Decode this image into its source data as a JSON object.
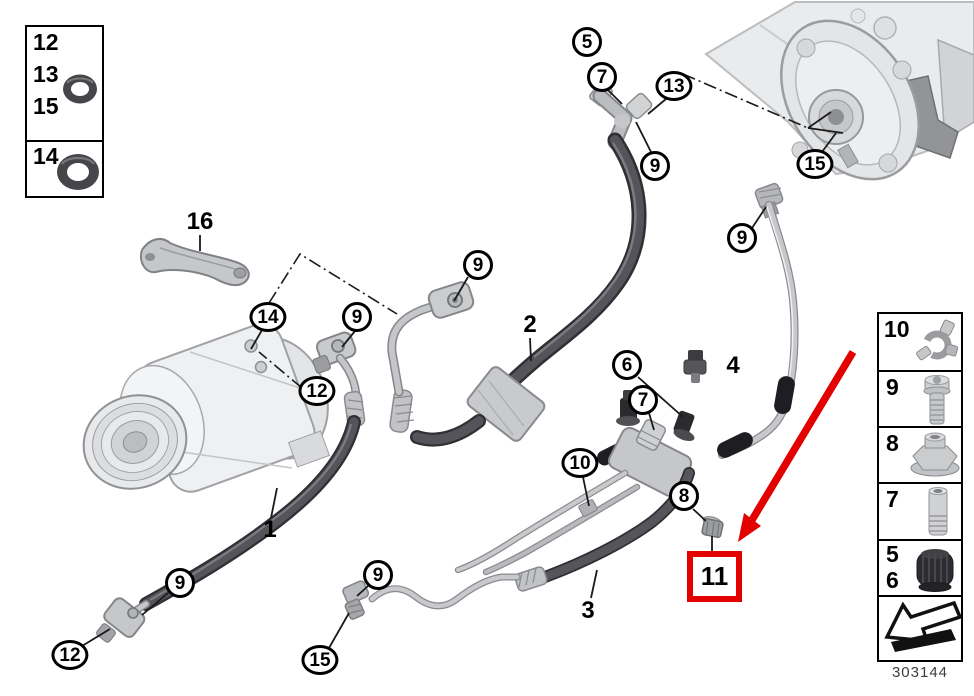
{
  "doc_number": "303144",
  "colors": {
    "highlight_red": "#e20000",
    "line_black": "#1a1a1a",
    "hose_dark": "#48484e",
    "pipe_light": "#c7c8cb"
  },
  "left_legend": {
    "row1": [
      "12",
      "13",
      "15"
    ],
    "row2": [
      "14"
    ],
    "icons": [
      "o-ring-small-icon",
      "o-ring-large-icon"
    ]
  },
  "right_legend": {
    "rows": [
      {
        "num": "10",
        "icon": "pipe-clamp-icon"
      },
      {
        "num": "9",
        "icon": "bolt-icon"
      },
      {
        "num": "8",
        "icon": "flange-nut-icon"
      },
      {
        "num": "7",
        "icon": "sleeve-icon"
      },
      {
        "num": "5",
        "num2": "6",
        "icon": "sealing-cap-icon"
      },
      {
        "icon": "direction-arrow-icon"
      }
    ]
  },
  "callouts": [
    {
      "label": "5"
    },
    {
      "label": "7"
    },
    {
      "label": "13"
    },
    {
      "label": "9"
    },
    {
      "label": "15"
    },
    {
      "label": "9"
    },
    {
      "label": "16"
    },
    {
      "label": "14"
    },
    {
      "label": "9"
    },
    {
      "label": "12"
    },
    {
      "label": "9"
    },
    {
      "label": "2"
    },
    {
      "label": "6"
    },
    {
      "label": "4"
    },
    {
      "label": "7"
    },
    {
      "label": "10"
    },
    {
      "label": "8"
    },
    {
      "label": "3"
    },
    {
      "label": "9"
    },
    {
      "label": "12"
    },
    {
      "label": "9"
    },
    {
      "label": "15"
    },
    {
      "label": "1"
    }
  ],
  "highlight": {
    "label": "11"
  }
}
